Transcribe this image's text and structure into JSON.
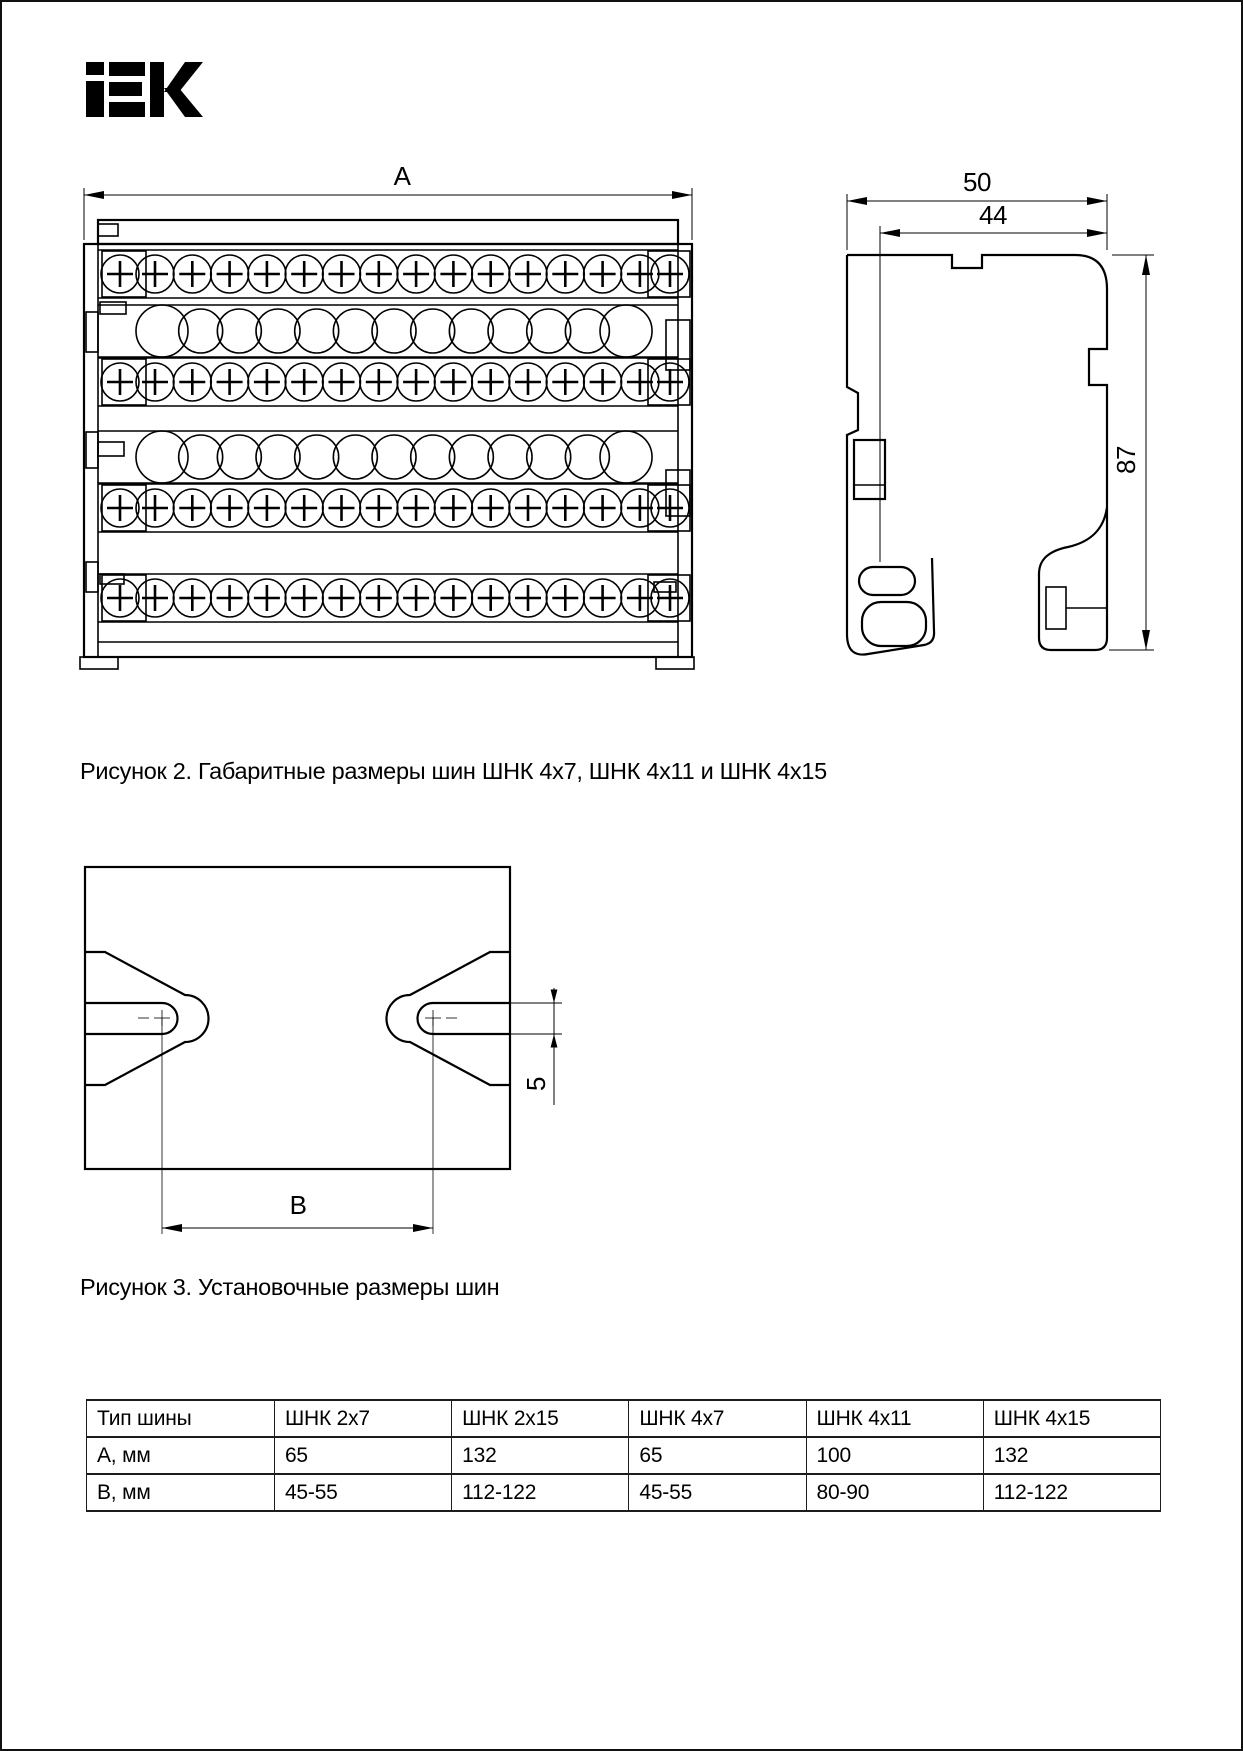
{
  "logo": {
    "brand": "IEK"
  },
  "figure2": {
    "caption": "Рисунок 2. Габаритные размеры шин ШНК 4х7, ШНК 4х11 и ШНК 4х15",
    "dims": {
      "a": "A",
      "d50": "50",
      "d44": "44",
      "d87": "87"
    }
  },
  "figure3": {
    "caption": "Рисунок 3. Установочные размеры шин",
    "dims": {
      "b": "B",
      "d5": "5"
    }
  },
  "table": {
    "headers": [
      "Тип шины",
      "ШНК 2х7",
      "ШНК 2х15",
      "ШНК 4х7",
      "ШНК 4х11",
      "ШНК 4х15"
    ],
    "rows": [
      {
        "label": "А, мм",
        "values": [
          "65",
          "132",
          "65",
          "100",
          "132"
        ]
      },
      {
        "label": "В, мм",
        "values": [
          "45-55",
          "112-122",
          "45-55",
          "80-90",
          "112-122"
        ]
      }
    ]
  },
  "colors": {
    "ink": "#000000",
    "paper": "#ffffff"
  }
}
